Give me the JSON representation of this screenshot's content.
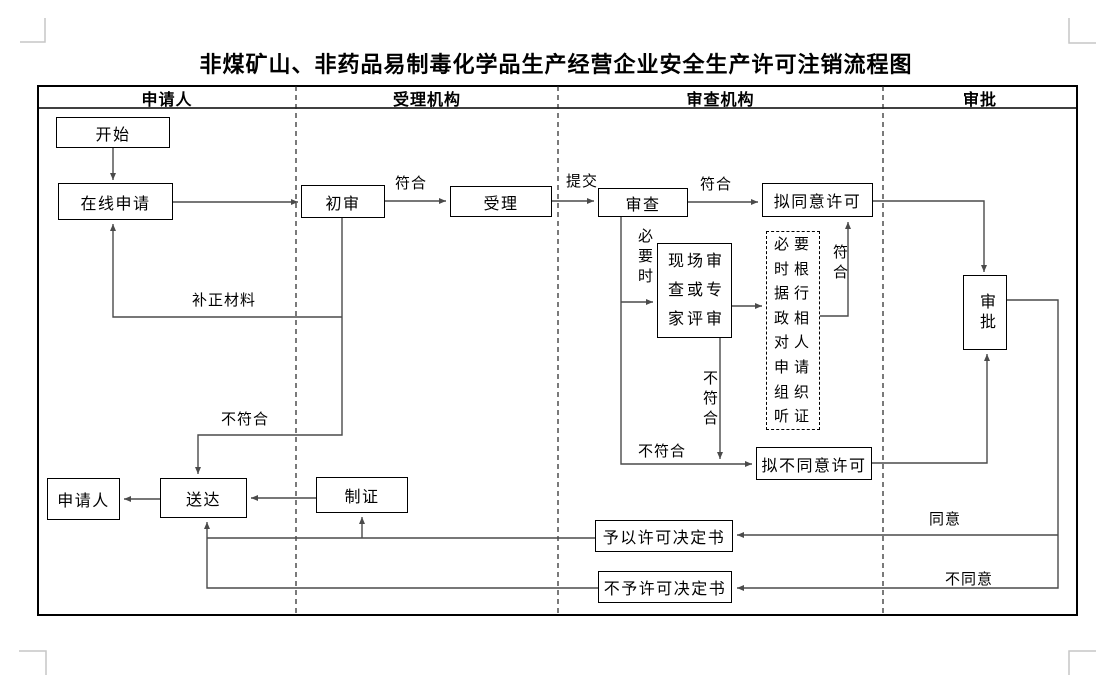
{
  "title": "非煤矿山、非药品易制毒化学品生产经营企业安全生产许可注销流程图",
  "lanes": [
    {
      "label": "申请人"
    },
    {
      "label": "受理机构"
    },
    {
      "label": "审查机构"
    },
    {
      "label": "审批"
    }
  ],
  "nodes": {
    "start": {
      "label": "开始"
    },
    "online_apply": {
      "label": "在线申请"
    },
    "initial_review": {
      "label": "初审"
    },
    "accept": {
      "label": "受理"
    },
    "review": {
      "label": "审查"
    },
    "propose_approve": {
      "label": "拟同意许可"
    },
    "site_review": {
      "label": "现场审查或专家评审"
    },
    "hearing": {
      "label": "必要时根据行政相对人申请组织听证"
    },
    "propose_reject": {
      "label": "拟不同意许可"
    },
    "approve": {
      "label": "审批"
    },
    "applicant": {
      "label": "申请人"
    },
    "deliver": {
      "label": "送达"
    },
    "make_cert": {
      "label": "制证"
    },
    "permit_decision": {
      "label": "予以许可决定书"
    },
    "no_permit_decision": {
      "label": "不予许可决定书"
    }
  },
  "edge_labels": {
    "conform1": "符合",
    "submit": "提交",
    "conform2": "符合",
    "supplement_material": "补正材料",
    "not_conform_initial": "不符合",
    "when_necessary": "必要时",
    "not_conform_site": "不符合",
    "conform_hearing": "符合",
    "not_conform_review": "不符合",
    "agree": "同意",
    "disagree": "不同意"
  },
  "colors": {
    "connector": "#4a4a4a",
    "box_border": "#000000",
    "margin_mark": "#c6c6c6"
  }
}
